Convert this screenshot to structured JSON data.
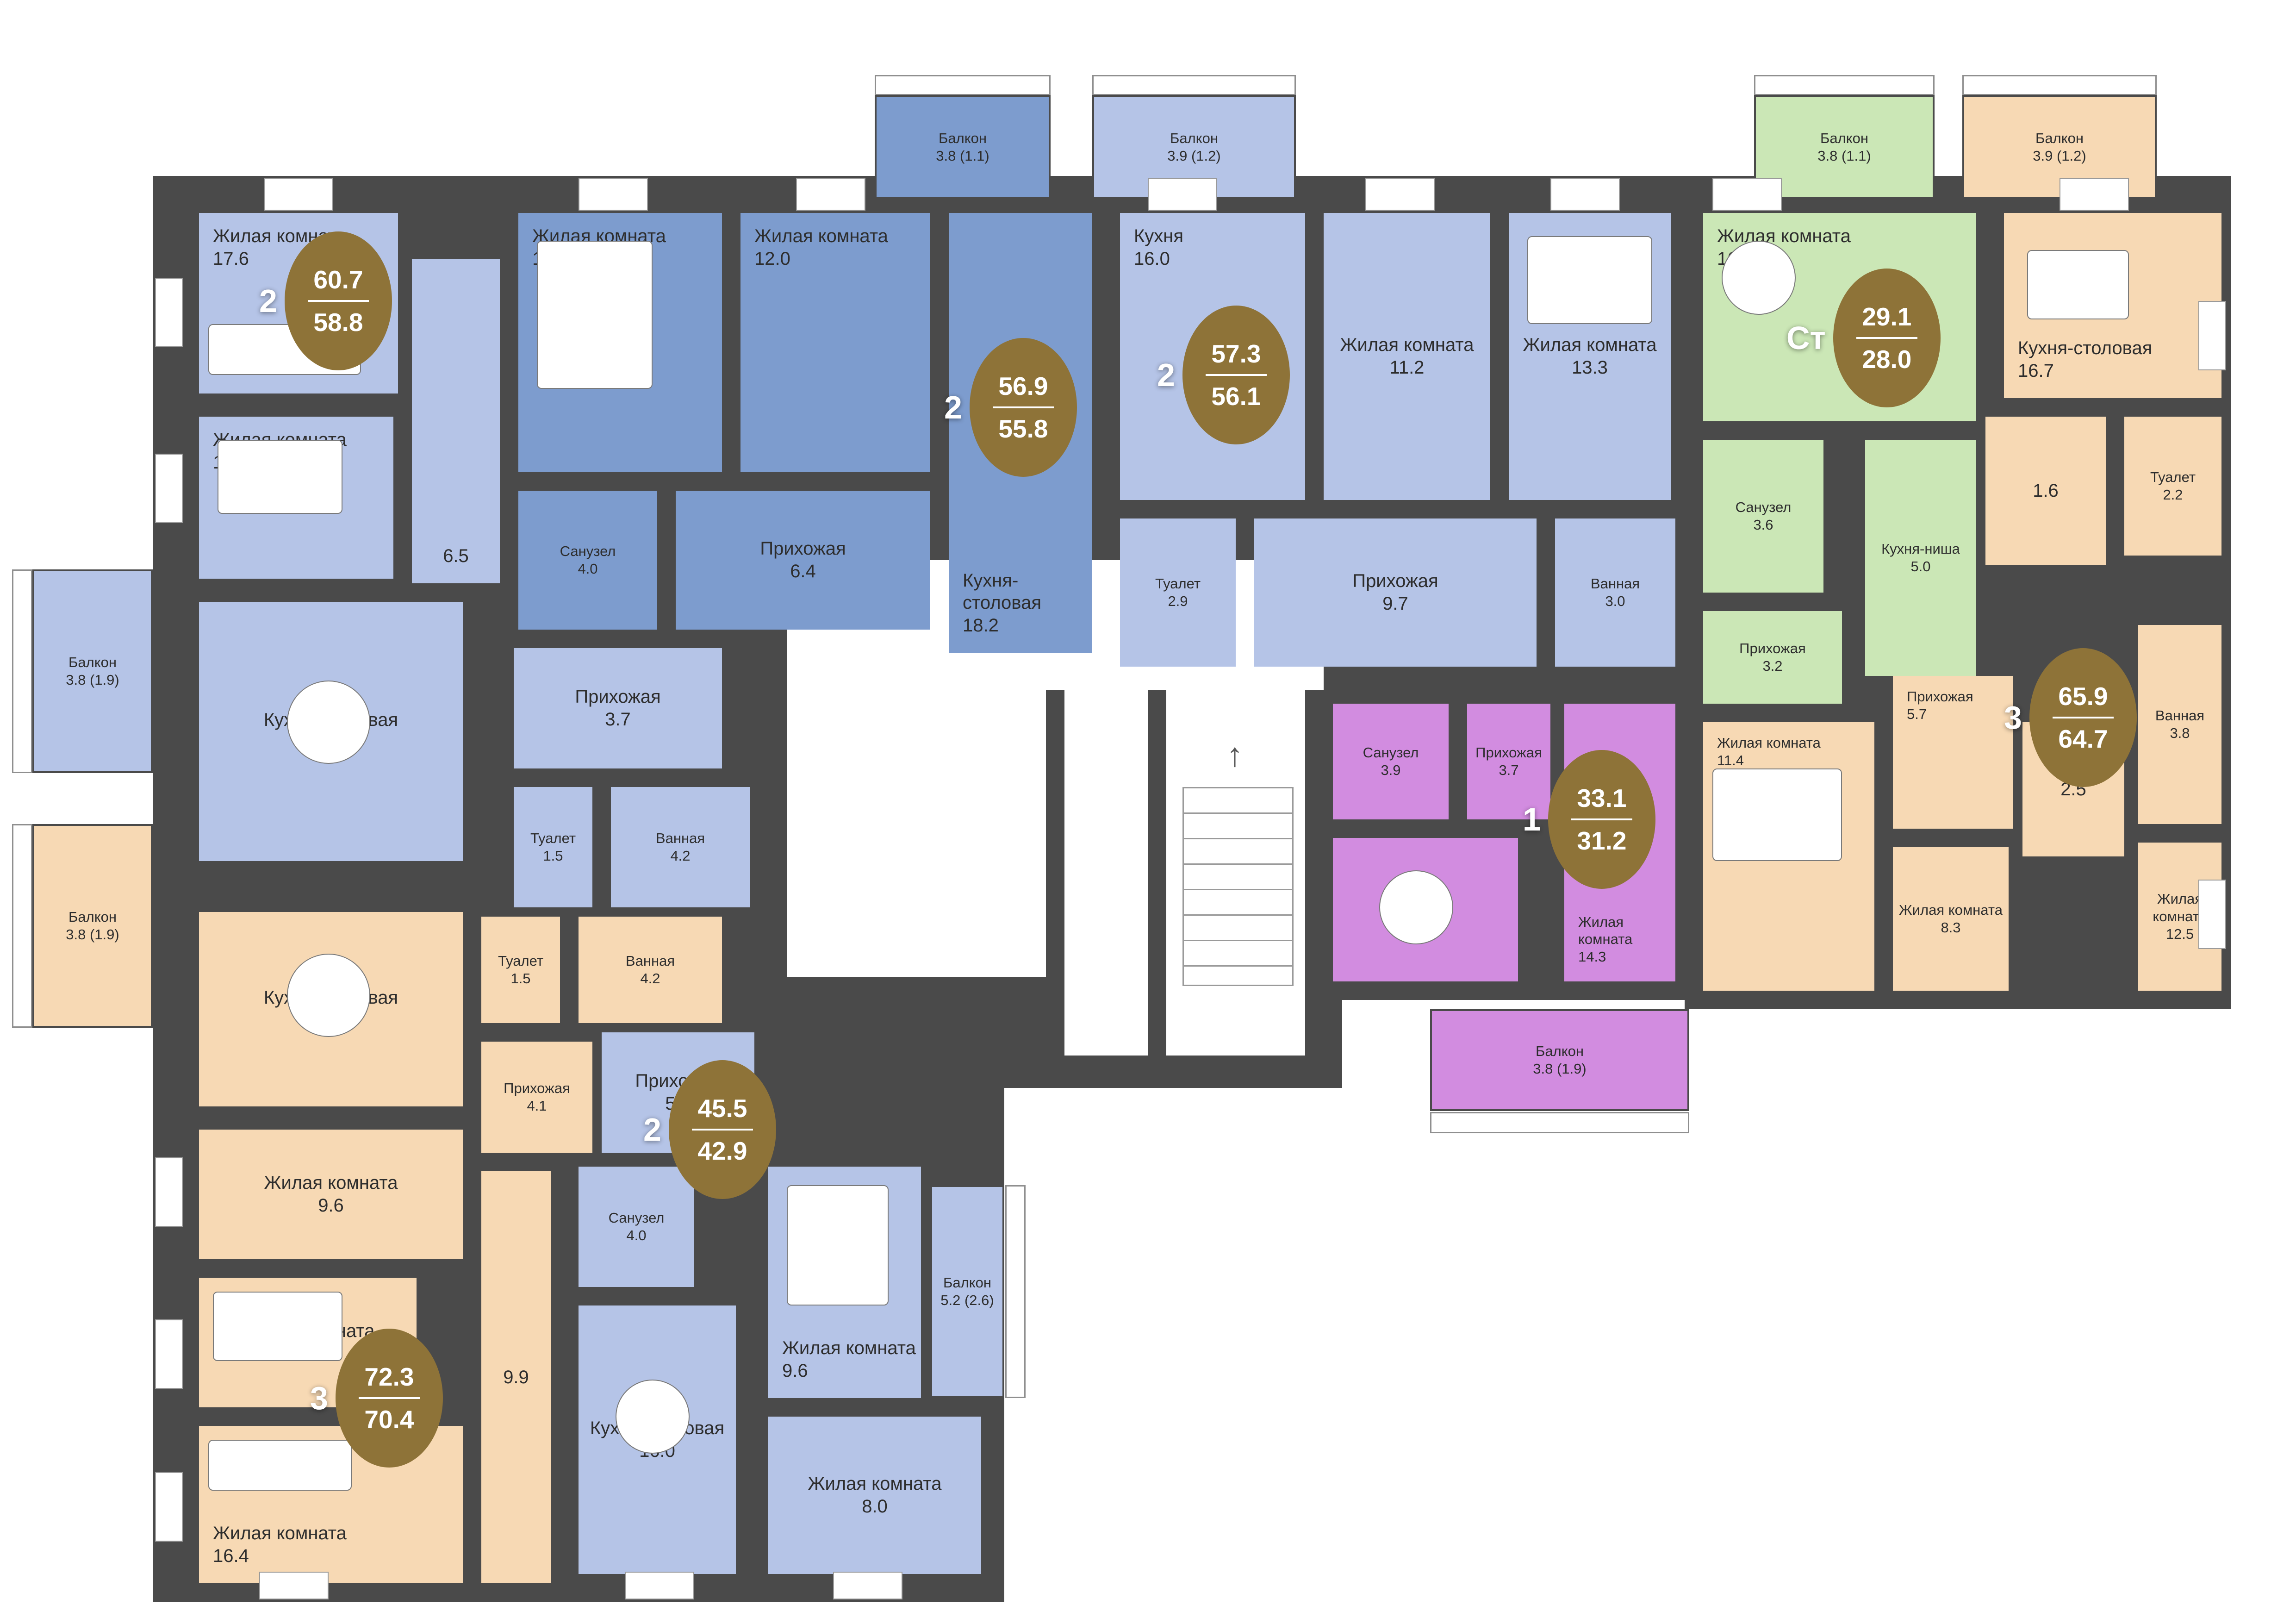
{
  "plan": {
    "type": "residential-floor-plan",
    "colors": {
      "wall": "#4a4a4a",
      "apartment_light_blue": "#b5c4e7",
      "apartment_dark_blue": "#7d9cce",
      "apartment_green": "#cbe7b6",
      "apartment_orange": "#f7d9b4",
      "apartment_purple": "#d28ce0",
      "badge": "#8e7338",
      "badge_text": "#ffffff",
      "label_text": "#2d2d2d"
    },
    "apartments": [
      {
        "id": "apt-2k-60-7",
        "rooms_count": "2",
        "area_total": "60.7",
        "area_living": "58.8",
        "color": "#b5c4e7",
        "rooms": [
          {
            "label": "Жилая комната",
            "area": "17.6"
          },
          {
            "label": "Жилая комната",
            "area": "10.1"
          },
          {
            "label": "Кухня-столовая",
            "area": "15.2"
          },
          {
            "label": "",
            "area": "6.5"
          },
          {
            "label": "Прихожая",
            "area": "3.7"
          },
          {
            "label": "Туалет",
            "area": "1.5"
          },
          {
            "label": "Ванная",
            "area": "4.2"
          },
          {
            "label": "Балкон",
            "area": "3.8 (1.9)"
          }
        ]
      },
      {
        "id": "apt-2k-56-9",
        "rooms_count": "2",
        "area_total": "56.9",
        "area_living": "55.8",
        "color": "#7d9cce",
        "rooms": [
          {
            "label": "Жилая комната",
            "area": "15.2"
          },
          {
            "label": "Жилая комната",
            "area": "12.0"
          },
          {
            "label": "Кухня-столовая",
            "area": "18.2"
          },
          {
            "label": "Санузел",
            "area": "4.0"
          },
          {
            "label": "Прихожая",
            "area": "6.4"
          },
          {
            "label": "Балкон",
            "area": "3.8 (1.1)"
          }
        ]
      },
      {
        "id": "apt-2k-57-3",
        "rooms_count": "2",
        "area_total": "57.3",
        "area_living": "56.1",
        "color": "#b5c4e7",
        "rooms": [
          {
            "label": "Кухня",
            "area": "16.0"
          },
          {
            "label": "Жилая комната",
            "area": "11.2"
          },
          {
            "label": "Жилая комната",
            "area": "13.3"
          },
          {
            "label": "Туалет",
            "area": "2.9"
          },
          {
            "label": "Прихожая",
            "area": "9.7"
          },
          {
            "label": "Ванная",
            "area": "3.0"
          },
          {
            "label": "Балкон",
            "area": "3.9 (1.2)"
          }
        ]
      },
      {
        "id": "apt-studio-29-1",
        "rooms_count": "Ст",
        "area_total": "29.1",
        "area_living": "28.0",
        "color": "#cbe7b6",
        "rooms": [
          {
            "label": "Жилая комната",
            "area": "16.2"
          },
          {
            "label": "Кухня-ниша",
            "area": "5.0"
          },
          {
            "label": "Санузел",
            "area": "3.6"
          },
          {
            "label": "Прихожая",
            "area": "3.2"
          },
          {
            "label": "Балкон",
            "area": "3.8 (1.1)"
          }
        ]
      },
      {
        "id": "apt-3k-65-9",
        "rooms_count": "3",
        "area_total": "65.9",
        "area_living": "64.7",
        "color": "#f7d9b4",
        "rooms": [
          {
            "label": "Кухня-столовая",
            "area": "16.7"
          },
          {
            "label": "",
            "area": "1.6"
          },
          {
            "label": "Туалет",
            "area": "2.2"
          },
          {
            "label": "Прихожая",
            "area": "5.7"
          },
          {
            "label": "Ванная",
            "area": "3.8"
          },
          {
            "label": "",
            "area": "2.5"
          },
          {
            "label": "Жилая комната",
            "area": "11.4"
          },
          {
            "label": "Жилая комната",
            "area": "8.3"
          },
          {
            "label": "Жилая комната",
            "area": "12.5"
          },
          {
            "label": "Балкон",
            "area": "3.9 (1.2)"
          }
        ]
      },
      {
        "id": "apt-1k-33-1",
        "rooms_count": "1",
        "area_total": "33.1",
        "area_living": "31.2",
        "color": "#d28ce0",
        "rooms": [
          {
            "label": "Санузел",
            "area": "3.9"
          },
          {
            "label": "Прихожая",
            "area": "3.7"
          },
          {
            "label": "Кухня",
            "area": "9.3"
          },
          {
            "label": "Жилая комната",
            "area": "14.3"
          },
          {
            "label": "Балкон",
            "area": "3.8 (1.9)"
          }
        ]
      },
      {
        "id": "apt-2k-45-5",
        "rooms_count": "2",
        "area_total": "45.5",
        "area_living": "42.9",
        "color": "#b5c4e7",
        "rooms": [
          {
            "label": "Прихожая",
            "area": "5.3"
          },
          {
            "label": "Санузел",
            "area": "4.0"
          },
          {
            "label": "Жилая комната",
            "area": "9.6"
          },
          {
            "label": "Кухня-столовая",
            "area": "16.0"
          },
          {
            "label": "Жилая комната",
            "area": "8.0"
          },
          {
            "label": "Балкон",
            "area": "5.2 (2.6)"
          }
        ]
      },
      {
        "id": "apt-3k-72-3",
        "rooms_count": "3",
        "area_total": "72.3",
        "area_living": "70.4",
        "color": "#f7d9b4",
        "rooms": [
          {
            "label": "Кухня-столовая",
            "area": "14.3"
          },
          {
            "label": "Туалет",
            "area": "1.5"
          },
          {
            "label": "Ванная",
            "area": "4.2"
          },
          {
            "label": "Прихожая",
            "area": "4.1"
          },
          {
            "label": "",
            "area": "9.9"
          },
          {
            "label": "Жилая комната",
            "area": "9.6"
          },
          {
            "label": "Жилая комната",
            "area": "10.4"
          },
          {
            "label": "Жилая комната",
            "area": "16.4"
          },
          {
            "label": "Балкон",
            "area": "3.8 (1.9)"
          }
        ]
      }
    ]
  }
}
